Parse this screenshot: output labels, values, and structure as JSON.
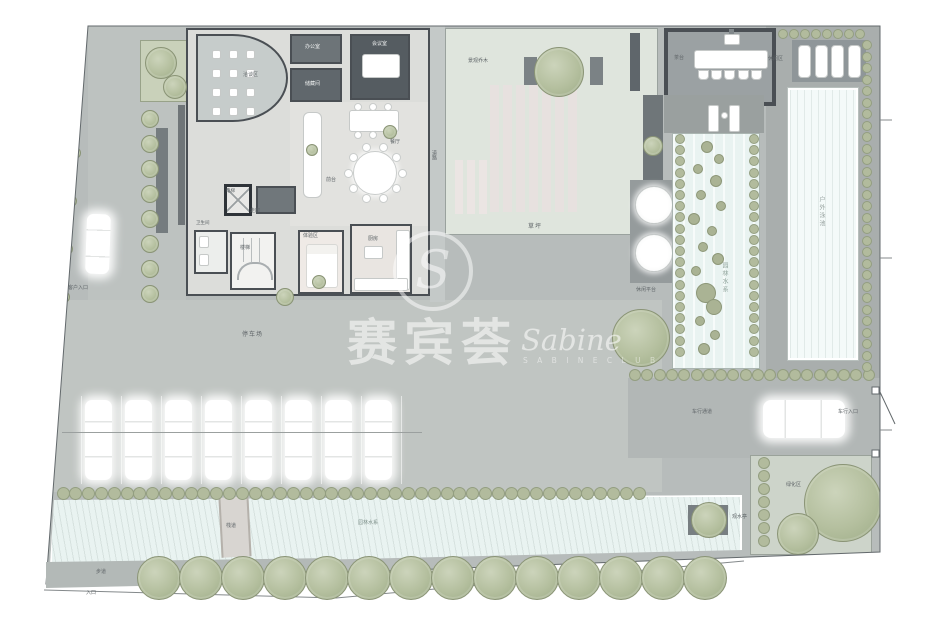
{
  "watermark": {
    "logo_letter": "S",
    "brand_cn": "赛宾荟",
    "brand_en": "Sabine",
    "brand_sub": "S A B I N E  C L U B"
  },
  "colors": {
    "pavement": "#b7bcbb",
    "plaza": "#c0c5c2",
    "deck": "#a9aead",
    "lawn": "#dfe5dd",
    "water": "#e9f3f1",
    "pool": "#f4faf9",
    "tree": "#b4bf9e",
    "wall": "#4a4f54"
  },
  "labels": {
    "lawn": "草坪",
    "lawn_tree": "景观乔木",
    "road": "道路",
    "pavilion": "茶台",
    "loungers": "休闲区",
    "pool": "户外泳池",
    "water_garden": "园林水系",
    "platform": "休闲平台",
    "parking": "停车场",
    "client_entrance": "客户入口",
    "drive": "车行通道",
    "drive_entrance": "车行入口",
    "stream": "园林水系",
    "bridge": "栈道",
    "island": "观水亭",
    "garden": "绿化区",
    "path": "步道",
    "entrance": "入口"
  },
  "rooms": {
    "negotiation": "洽谈区",
    "office": "办公室",
    "storage": "储藏间",
    "meeting": "会议室",
    "front_desk": "前台",
    "dining": "餐厅",
    "corridor": "走廊",
    "elevator": "电梯",
    "stairs": "楼梯",
    "restroom": "卫生间",
    "experience": "体验区",
    "kitchen": "厨房"
  },
  "counts": {
    "parking_cars": 8,
    "sun_loungers": 4,
    "bottom_trees": 14,
    "left_trees": 8,
    "pavilion_chairs": 5,
    "round_table_seats": 10,
    "curved_room_seats": 12
  }
}
